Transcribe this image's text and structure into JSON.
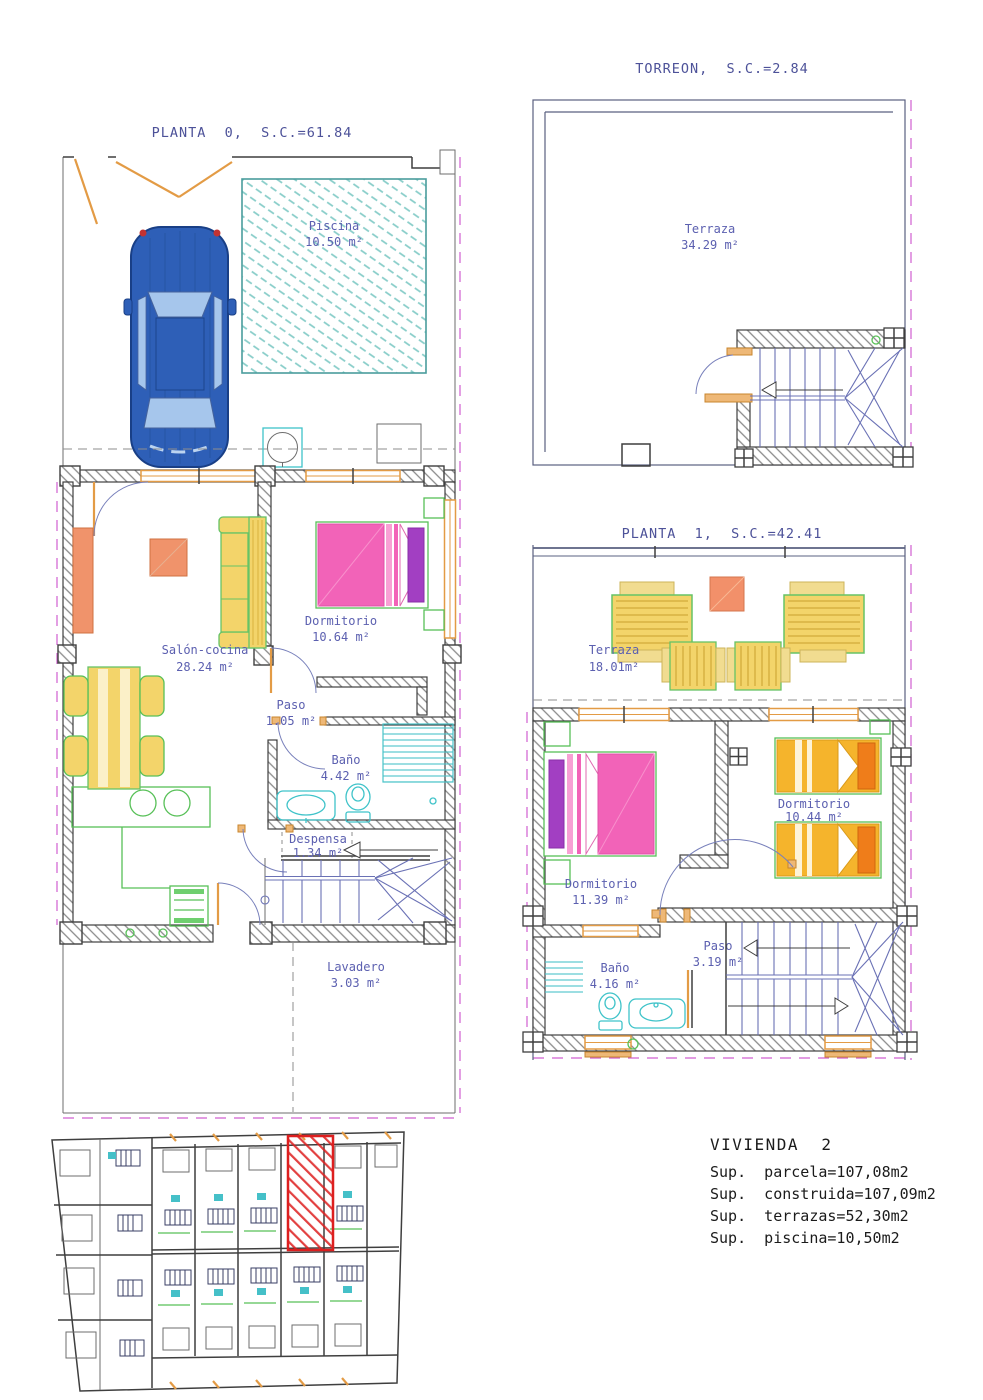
{
  "plans": {
    "planta0": {
      "title": "PLANTA  0,  S.C.=61.84",
      "rooms": {
        "piscina": {
          "name": "Piscina",
          "area": "10.50 m²"
        },
        "salon": {
          "name": "Salón-cocina",
          "area": "28.24 m²"
        },
        "dormitorio": {
          "name": "Dormitorio",
          "area": "10.64 m²"
        },
        "paso": {
          "name": "Paso",
          "area": "1.05 m²"
        },
        "bano": {
          "name": "Baño",
          "area": "4.42 m²"
        },
        "despensa": {
          "name": "Despensa",
          "area": "1.34 m²"
        },
        "lavadero": {
          "name": "Lavadero",
          "area": "3.03 m²"
        }
      }
    },
    "torreon": {
      "title": "TORREON,  S.C.=2.84",
      "rooms": {
        "terraza": {
          "name": "Terraza",
          "area": "34.29 m²"
        }
      }
    },
    "planta1": {
      "title": "PLANTA  1,  S.C.=42.41",
      "rooms": {
        "terraza": {
          "name": "Terraza",
          "area": "18.01m²"
        },
        "dormitorio1": {
          "name": "Dormitorio",
          "area": "11.39 m²"
        },
        "dormitorio2": {
          "name": "Dormitorio",
          "area": "10.44 m²"
        },
        "paso": {
          "name": "Paso",
          "area": "3.19 m²"
        },
        "bano": {
          "name": "Baño",
          "area": "4.16 m²"
        }
      }
    }
  },
  "summary": {
    "title": "VIVIENDA  2",
    "lines": [
      "Sup.  parcela=107,08m2",
      "Sup.  construida=107,09m2",
      "Sup.  terrazas=52,30m2",
      "Sup.  piscina=10,50m2"
    ]
  },
  "colors": {
    "title_blue": "#4d5299",
    "label_blue": "#5c60b0",
    "wall_gray": "#3f3f3f",
    "window_orange": "#e39b45",
    "fixture_cyan": "#3fc3c9",
    "pool_teal": "#4a9d9d",
    "boundary_magenta": "#d05fd0",
    "stair_blue": "#6a71b5",
    "bed_pink": "#f263b8",
    "pillow_purple": "#a23fc2",
    "bed_orange": "#f5b42c",
    "pillow_orange": "#ef7d1a",
    "furniture_yellow": "#f3d46a",
    "furniture_green": "#57c057",
    "furniture_salmon": "#f0936b",
    "car_blue": "#2e5fb7",
    "highlight_red": "#dd1f1f",
    "text_black": "#1b1b1b"
  }
}
